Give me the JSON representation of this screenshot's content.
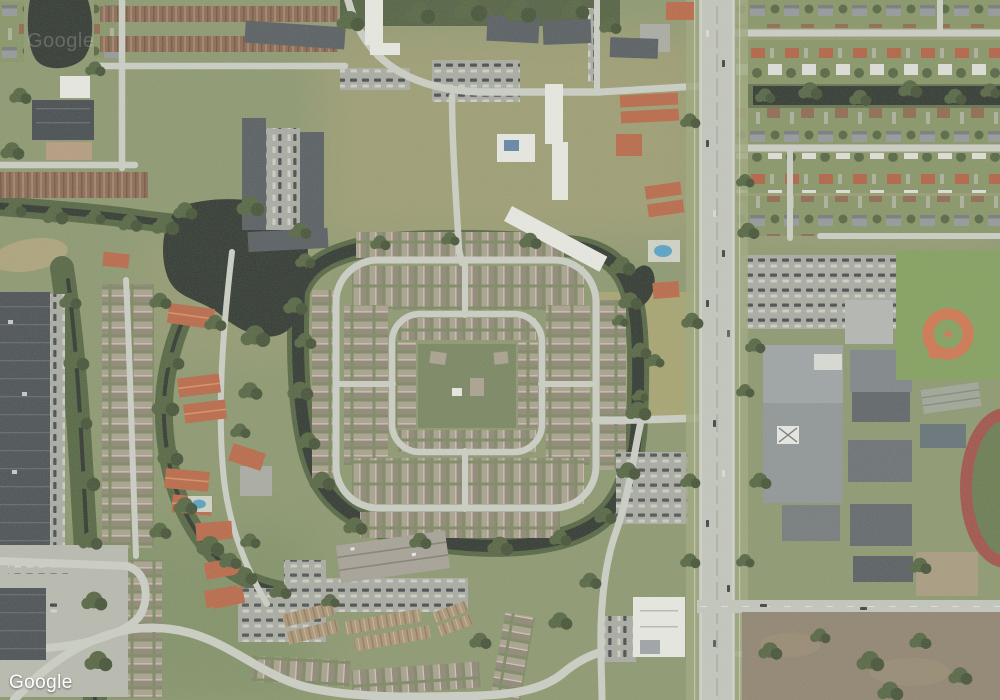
{
  "map": {
    "provider": "Google",
    "view_type": "satellite",
    "watermark_text": "Google",
    "faint_watermark_text": "Google"
  },
  "palette": {
    "grass": "#87946a",
    "verge": "#99a377",
    "dry": "#b3a172",
    "fieldgreen": "#7e9c57",
    "dryfield": "#a6a26c",
    "tree": "#4c5e39",
    "treedark": "#3b4a2d",
    "water": "#252d26",
    "road": "#cbcec4",
    "roadmajor": "#c2c5bc",
    "lane": "#e6e8df",
    "asphalt": "#a6a9a0",
    "lot": "#76835a",
    "rooftan": "#a79d8b",
    "roofshade": "#8b8171",
    "ridge": "#d0c7b3",
    "sgray": "#909496",
    "sbrown": "#8a6248",
    "sred": "#b05a3c",
    "swhite": "#dfe0da",
    "slot": "#82905f",
    "apartment": "#4e555a",
    "white": "#e9ebe4",
    "redtile": "#b8613f",
    "redridge": "#d98a5c",
    "warehouse": "#41474b",
    "clay": "#cf6f48",
    "track": "#9c4a41",
    "trackin": "#62764a",
    "dirt": "#8b7f6a",
    "dirtlight": "#a5977a",
    "pool": "#4f9ec4",
    "cardark": "#33383c",
    "carlight": "#dcdcd6",
    "thbrown": "#86634c",
    "thtan": "#a89070",
    "aptbar": "#a39e94"
  },
  "features": {
    "visible_landmarks": [
      "pond",
      "canal-network",
      "gated-residential-community",
      "apartment-complexes",
      "townhome-rows",
      "red-tile-condos",
      "warehouse-building",
      "school-campus",
      "baseball-diamond",
      "running-track",
      "parking-lots",
      "main-road",
      "suburban-street-grid",
      "vacant-field",
      "dirt-lot",
      "swimming-pools"
    ]
  }
}
